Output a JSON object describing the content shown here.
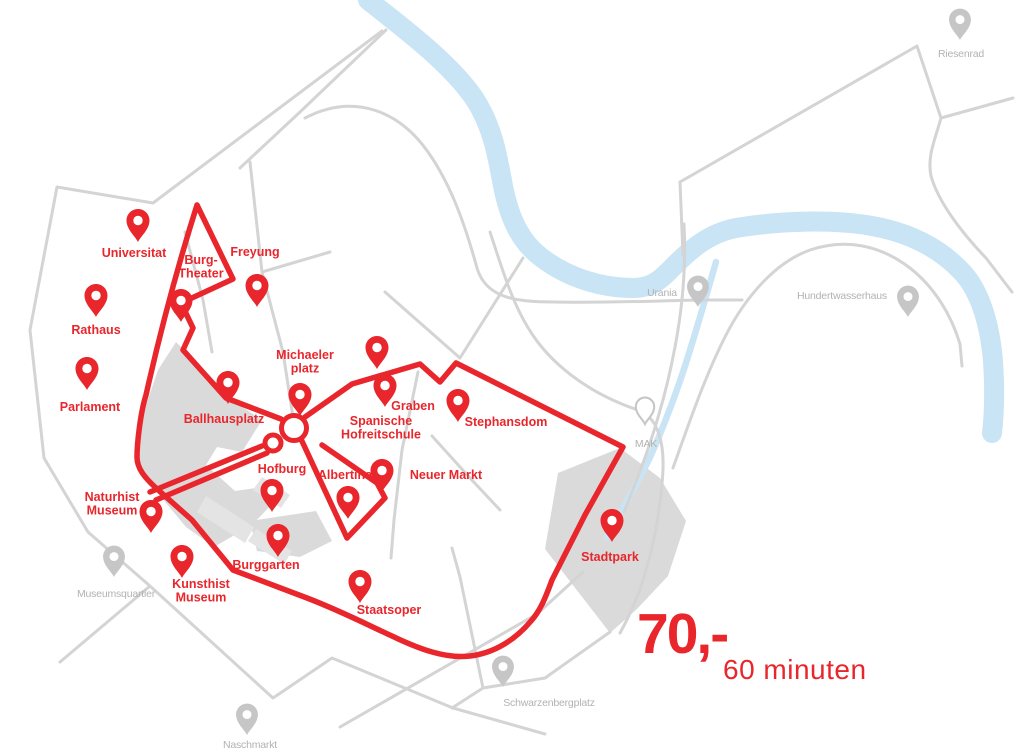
{
  "price": {
    "amount": "70,-",
    "duration": "60 minuten"
  },
  "colors": {
    "route": "#e8262c",
    "stop_label": "#e8262c",
    "river": "#c9e4f5",
    "road": "#d4d4d4",
    "park": "#dadada",
    "gray_pin": "#c6c6c6",
    "gray_label": "#b2b2b2"
  },
  "stops": [
    {
      "id": "universitaet",
      "label": [
        "Universitat"
      ],
      "pin": [
        138,
        242
      ],
      "label_pos": [
        134,
        257
      ]
    },
    {
      "id": "rathaus",
      "label": [
        "Rathaus"
      ],
      "pin": [
        96,
        317
      ],
      "label_pos": [
        96,
        334
      ]
    },
    {
      "id": "parlament",
      "label": [
        "Parlament"
      ],
      "pin": [
        87,
        390
      ],
      "label_pos": [
        90,
        411
      ]
    },
    {
      "id": "burgtheater",
      "label": [
        "Burg-",
        "Theater"
      ],
      "pin": [
        181,
        322
      ],
      "label_pos": [
        201,
        264
      ]
    },
    {
      "id": "freyung",
      "label": [
        "Freyung"
      ],
      "pin": [
        257,
        307
      ],
      "label_pos": [
        255,
        256
      ]
    },
    {
      "id": "ballhausplatz",
      "label": [
        "Ballhausplatz"
      ],
      "pin": [
        228,
        404
      ],
      "label_pos": [
        224,
        423
      ]
    },
    {
      "id": "michaelerplatz",
      "label": [
        "Michaeler",
        "platz"
      ],
      "pin": [
        300,
        416
      ],
      "label_pos": [
        305,
        359
      ]
    },
    {
      "id": "graben",
      "label": [
        "Graben"
      ],
      "pin": [
        377,
        369
      ],
      "label_pos": [
        413,
        410
      ]
    },
    {
      "id": "spanische-hofreitschule",
      "label": [
        "Spanische",
        "Hofreitschule"
      ],
      "pin": [
        385,
        407
      ],
      "label_pos": [
        381,
        425
      ]
    },
    {
      "id": "stephansdom",
      "label": [
        "Stephansdom"
      ],
      "pin": [
        458,
        422
      ],
      "label_pos": [
        506,
        426
      ]
    },
    {
      "id": "hofburg",
      "label": [
        "Hofburg"
      ],
      "pin": [
        272,
        512
      ],
      "label_pos": [
        282,
        473
      ]
    },
    {
      "id": "albertina",
      "label": [
        "Albertina"
      ],
      "pin": [
        348,
        519
      ],
      "label_pos": [
        345,
        479
      ]
    },
    {
      "id": "neuer-markt",
      "label": [
        "Neuer Markt"
      ],
      "pin": [
        382,
        492
      ],
      "label_pos": [
        446,
        479
      ]
    },
    {
      "id": "naturhist-museum",
      "label": [
        "Naturhist",
        "Museum"
      ],
      "pin": [
        151,
        533
      ],
      "label_pos": [
        112,
        501
      ]
    },
    {
      "id": "kunsthist-museum",
      "label": [
        "Kunsthist",
        "Museum"
      ],
      "pin": [
        182,
        578
      ],
      "label_pos": [
        201,
        588
      ]
    },
    {
      "id": "burggarten",
      "label": [
        "Burggarten"
      ],
      "pin": [
        278,
        557
      ],
      "label_pos": [
        266,
        569
      ]
    },
    {
      "id": "staatsoper",
      "label": [
        "Staatsoper"
      ],
      "pin": [
        360,
        603
      ],
      "label_pos": [
        389,
        614
      ]
    },
    {
      "id": "stadtpark",
      "label": [
        "Stadtpark"
      ],
      "pin": [
        612,
        542
      ],
      "label_pos": [
        610,
        561
      ]
    }
  ],
  "landmarks": [
    {
      "id": "riesenrad",
      "label": [
        "Riesenrad"
      ],
      "pin": [
        960,
        40
      ],
      "label_pos": [
        961,
        57
      ]
    },
    {
      "id": "urania",
      "label": [
        "Urania"
      ],
      "pin": [
        698,
        307
      ],
      "label_pos": [
        662,
        296
      ]
    },
    {
      "id": "hundertwasserhaus",
      "label": [
        "Hundertwasserhaus"
      ],
      "pin": [
        908,
        317
      ],
      "label_pos": [
        842,
        299
      ]
    },
    {
      "id": "mak",
      "label": [
        "MAK"
      ],
      "pin": [
        645,
        424
      ],
      "label_pos": [
        646,
        447
      ],
      "style": "outline",
      "scale": 0.8
    },
    {
      "id": "museumsquartier",
      "label": [
        "Museumsquartier"
      ],
      "pin": [
        114,
        577
      ],
      "label_pos": [
        116,
        597
      ]
    },
    {
      "id": "naschmarkt",
      "label": [
        "Naschmarkt"
      ],
      "pin": [
        247,
        735
      ],
      "label_pos": [
        250,
        748
      ]
    },
    {
      "id": "schwarzenbergplatz",
      "label": [
        "Schwarzenbergplatz"
      ],
      "pin": [
        503,
        687
      ],
      "label_pos": [
        549,
        706
      ]
    }
  ]
}
